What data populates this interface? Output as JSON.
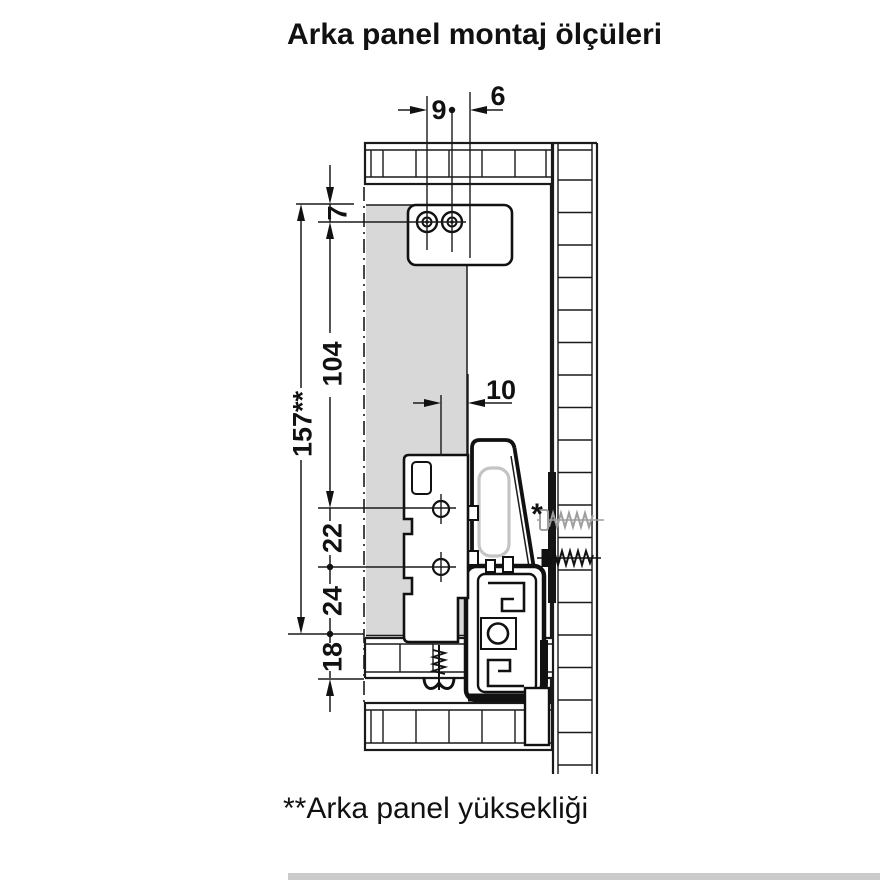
{
  "title": "Arka panel montaj ölçüleri",
  "footnote": "**Arka panel yüksekliği",
  "diagram": {
    "dimensions": {
      "hole_pitch_9": "9",
      "edge_offset_6": "6",
      "top_offset_7": "7",
      "mid_height_104": "104",
      "panel_height_157": "157**",
      "bracket_offset_10": "10",
      "bracket_hole_gap_22": "22",
      "lower_gap_24": "24",
      "base_height_18": "18"
    },
    "markers": {
      "footnote_ref": "*"
    },
    "colors": {
      "rear_panel_fill": "#d8d8d8",
      "line": "#1a1a1a",
      "slot_outline": "#c4c4c4",
      "alt_screw": "#9e9e9e",
      "scrollbar": "#cbcbcb"
    }
  }
}
